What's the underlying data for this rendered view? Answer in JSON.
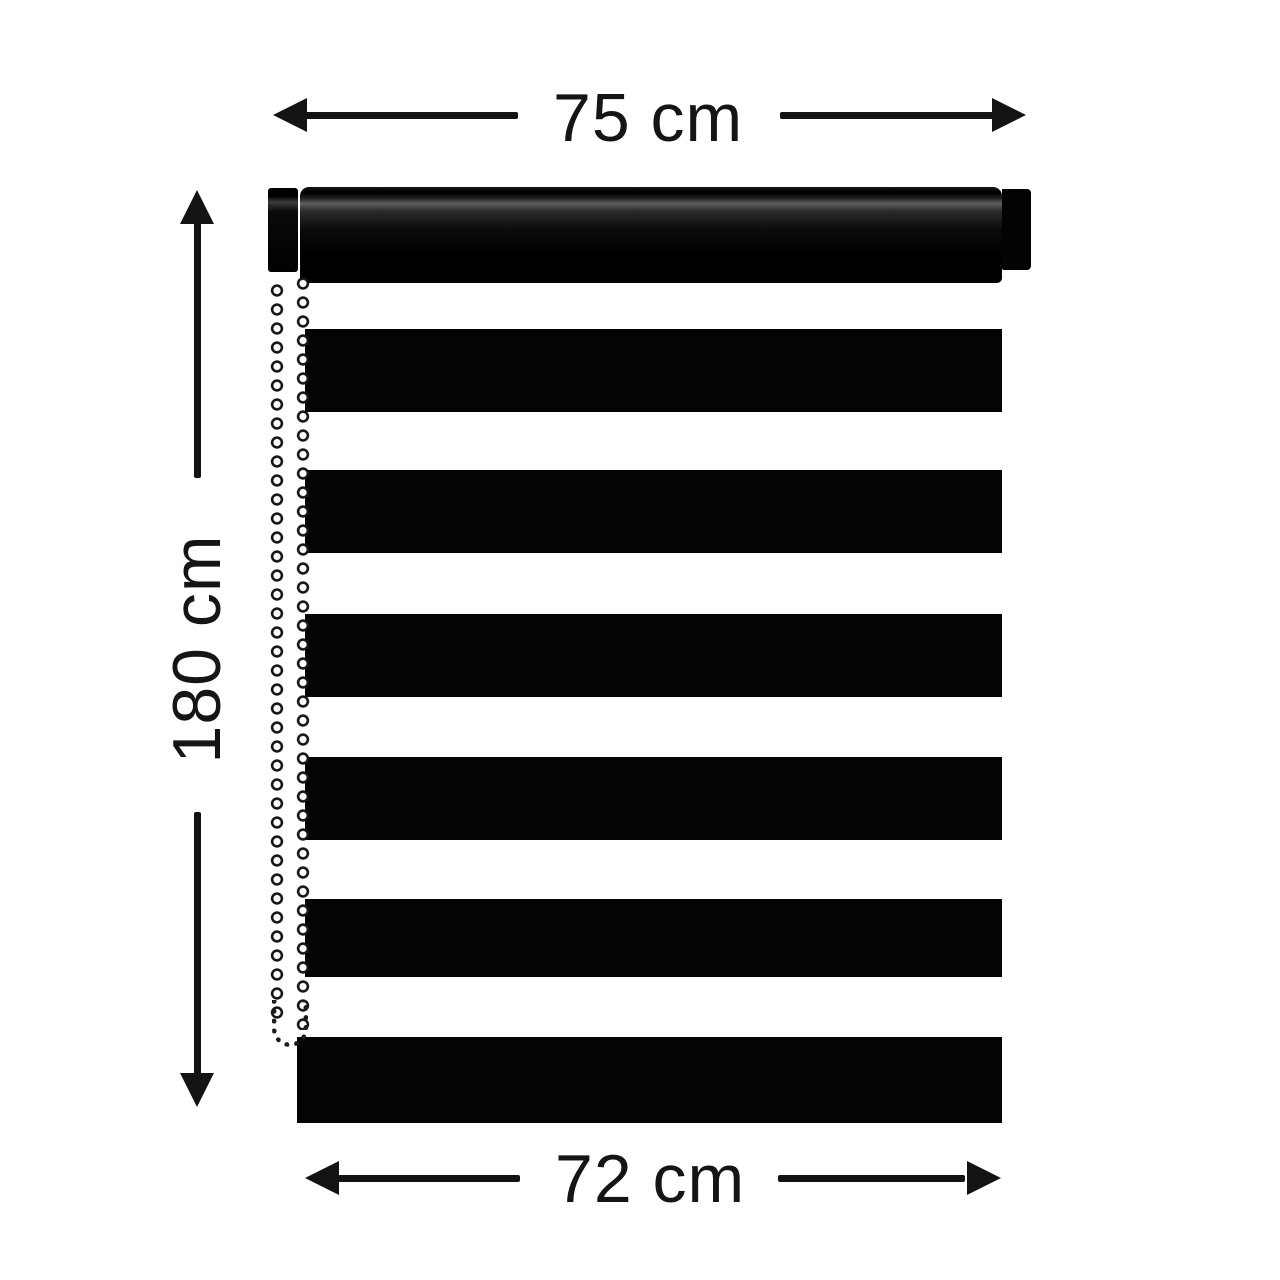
{
  "page": {
    "background": "#ffffff",
    "depicts": "Dimension diagram of a black zebra roller blind with headrail, side bead chain and six black fabric stripes"
  },
  "dimensions": {
    "top_width": "75 cm",
    "height": "180 cm",
    "bottom_width": "72 cm"
  },
  "blind": {
    "black_stripe_count": 6,
    "has_headrail": true,
    "has_side_bead_chain": true
  },
  "colors": {
    "ink": "#131313",
    "blind_fabric": "#040404",
    "chain_bead_fill": "#ffffff",
    "chain_bead_outline": "#161616",
    "background": "#ffffff"
  },
  "icons": {
    "arrowhead": "solid-triangle",
    "bead_chain": "repeating-ring-pattern"
  }
}
